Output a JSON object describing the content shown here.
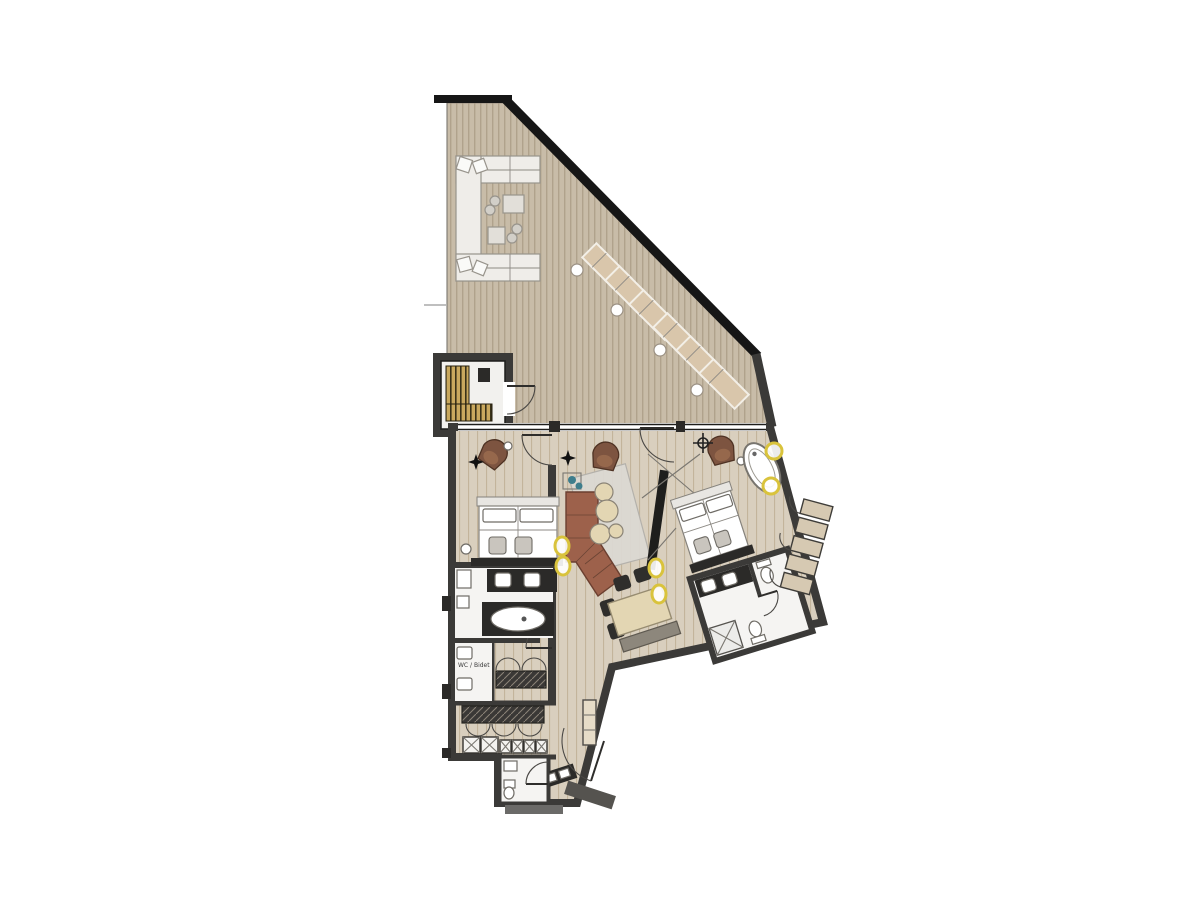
{
  "meta": {
    "type": "architectural-floor-plan",
    "description": "Apartment floor plan with large wrap-around roof terrace, sauna, two bedrooms, living-dining area, bathrooms and entrance hall"
  },
  "labels": {
    "wc_bidet": "WC / Bidet"
  },
  "rooms": [
    {
      "id": "terrace",
      "name": "roof terrace with lounge set and sun loungers"
    },
    {
      "id": "sauna",
      "name": "sauna cabin with wood benches"
    },
    {
      "id": "bedroom-left",
      "name": "left bedroom with double bed"
    },
    {
      "id": "bathroom-left",
      "name": "bathroom with double vanity and bathtub"
    },
    {
      "id": "wc-bidet",
      "name": "WC / Bidet room"
    },
    {
      "id": "corridor",
      "name": "corridor with built-in wardrobes"
    },
    {
      "id": "entrance-hall",
      "name": "entrance hall with closets"
    },
    {
      "id": "guest-wc",
      "name": "guest WC"
    },
    {
      "id": "living-dining",
      "name": "living and dining room"
    },
    {
      "id": "bedroom-right",
      "name": "right bedroom with freestanding bathtub"
    },
    {
      "id": "ensuite-bathroom",
      "name": "en-suite bathroom"
    }
  ],
  "furniture": [
    "outdoor-corner-sofa",
    "outdoor-coffee-tables",
    "sun-loungers",
    "lounger-side-tables",
    "sauna-benches",
    "double-bed-left",
    "bed-benches",
    "nightstand",
    "double-vanity",
    "bathtub-built-in",
    "toilet",
    "bidet",
    "wardrobe-row",
    "closet-boxes",
    "hall-cabinet",
    "sideboard",
    "corner-sofa-brown",
    "round-coffee-tables",
    "area-rug",
    "armchairs",
    "tv-partition",
    "dining-table",
    "dining-chairs",
    "dining-bench",
    "double-bed-right",
    "freestanding-oval-bathtub",
    "ensuite-double-vanity",
    "shower",
    "wardrobes-slanted-wall",
    "ceiling-lights"
  ],
  "colors": {
    "wall": "#3b3a38",
    "wall_black": "#161616",
    "deck_base": "#c8bca8",
    "deck_stripe": "#b0a28c",
    "floor_base": "#d9cfbe",
    "floor_stripe": "#c3b49b",
    "bathroom_floor": "#f5f4f2",
    "sofa_brown": "#9d614b",
    "sofa_edge": "#6b3f30",
    "armchair_brown": "#7d5440",
    "lounger": "#d9c6ab",
    "outdoor_sofa": "#efede9",
    "rug": "#dbd8d2",
    "table_wood": "#e3d6b3",
    "chair_dark": "#2f2e2c",
    "bench_gray": "#8d877c",
    "sauna_wood": "#c9a85e",
    "sauna_wood_dark": "#3a3218",
    "light_yellow": "#d9c33c",
    "teal": "#3e7d8c",
    "wardrobe_beige": "#d6c9b2"
  }
}
